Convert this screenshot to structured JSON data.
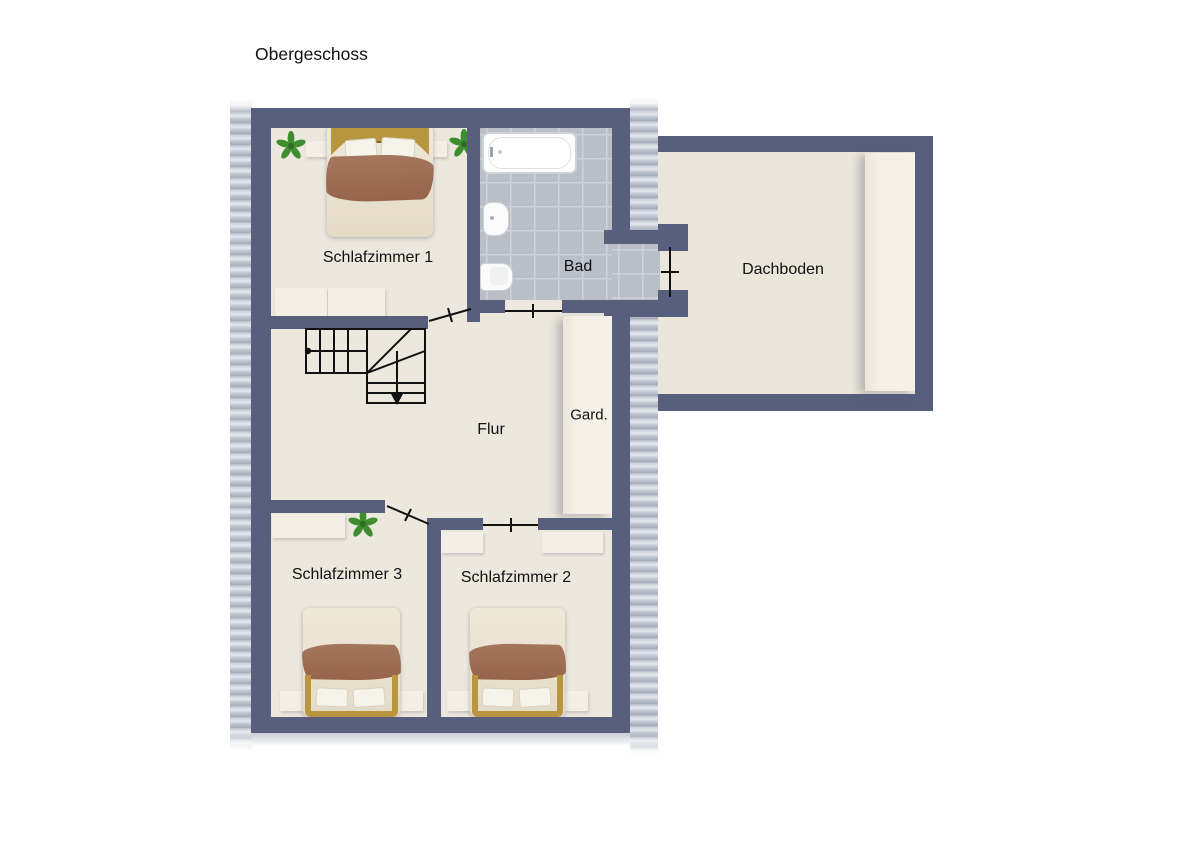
{
  "title": "Obergeschoss",
  "rooms": {
    "schlafzimmer1": "Schlafzimmer 1",
    "bad": "Bad",
    "dachboden": "Dachboden",
    "flur": "Flur",
    "garderobe": "Gard.",
    "schlafzimmer3": "Schlafzimmer 3",
    "schlafzimmer2": "Schlafzimmer 2"
  },
  "colors": {
    "wall": "#575f7d",
    "floor": "#ece8de",
    "wing_floor": "#eae6da",
    "tile": "#b9bec7",
    "tile_line": "#ced2d9",
    "blanket": "#9c6b52",
    "bed_frame": "#b8953f",
    "plant": "#3e8d2e",
    "text": "#111111"
  }
}
